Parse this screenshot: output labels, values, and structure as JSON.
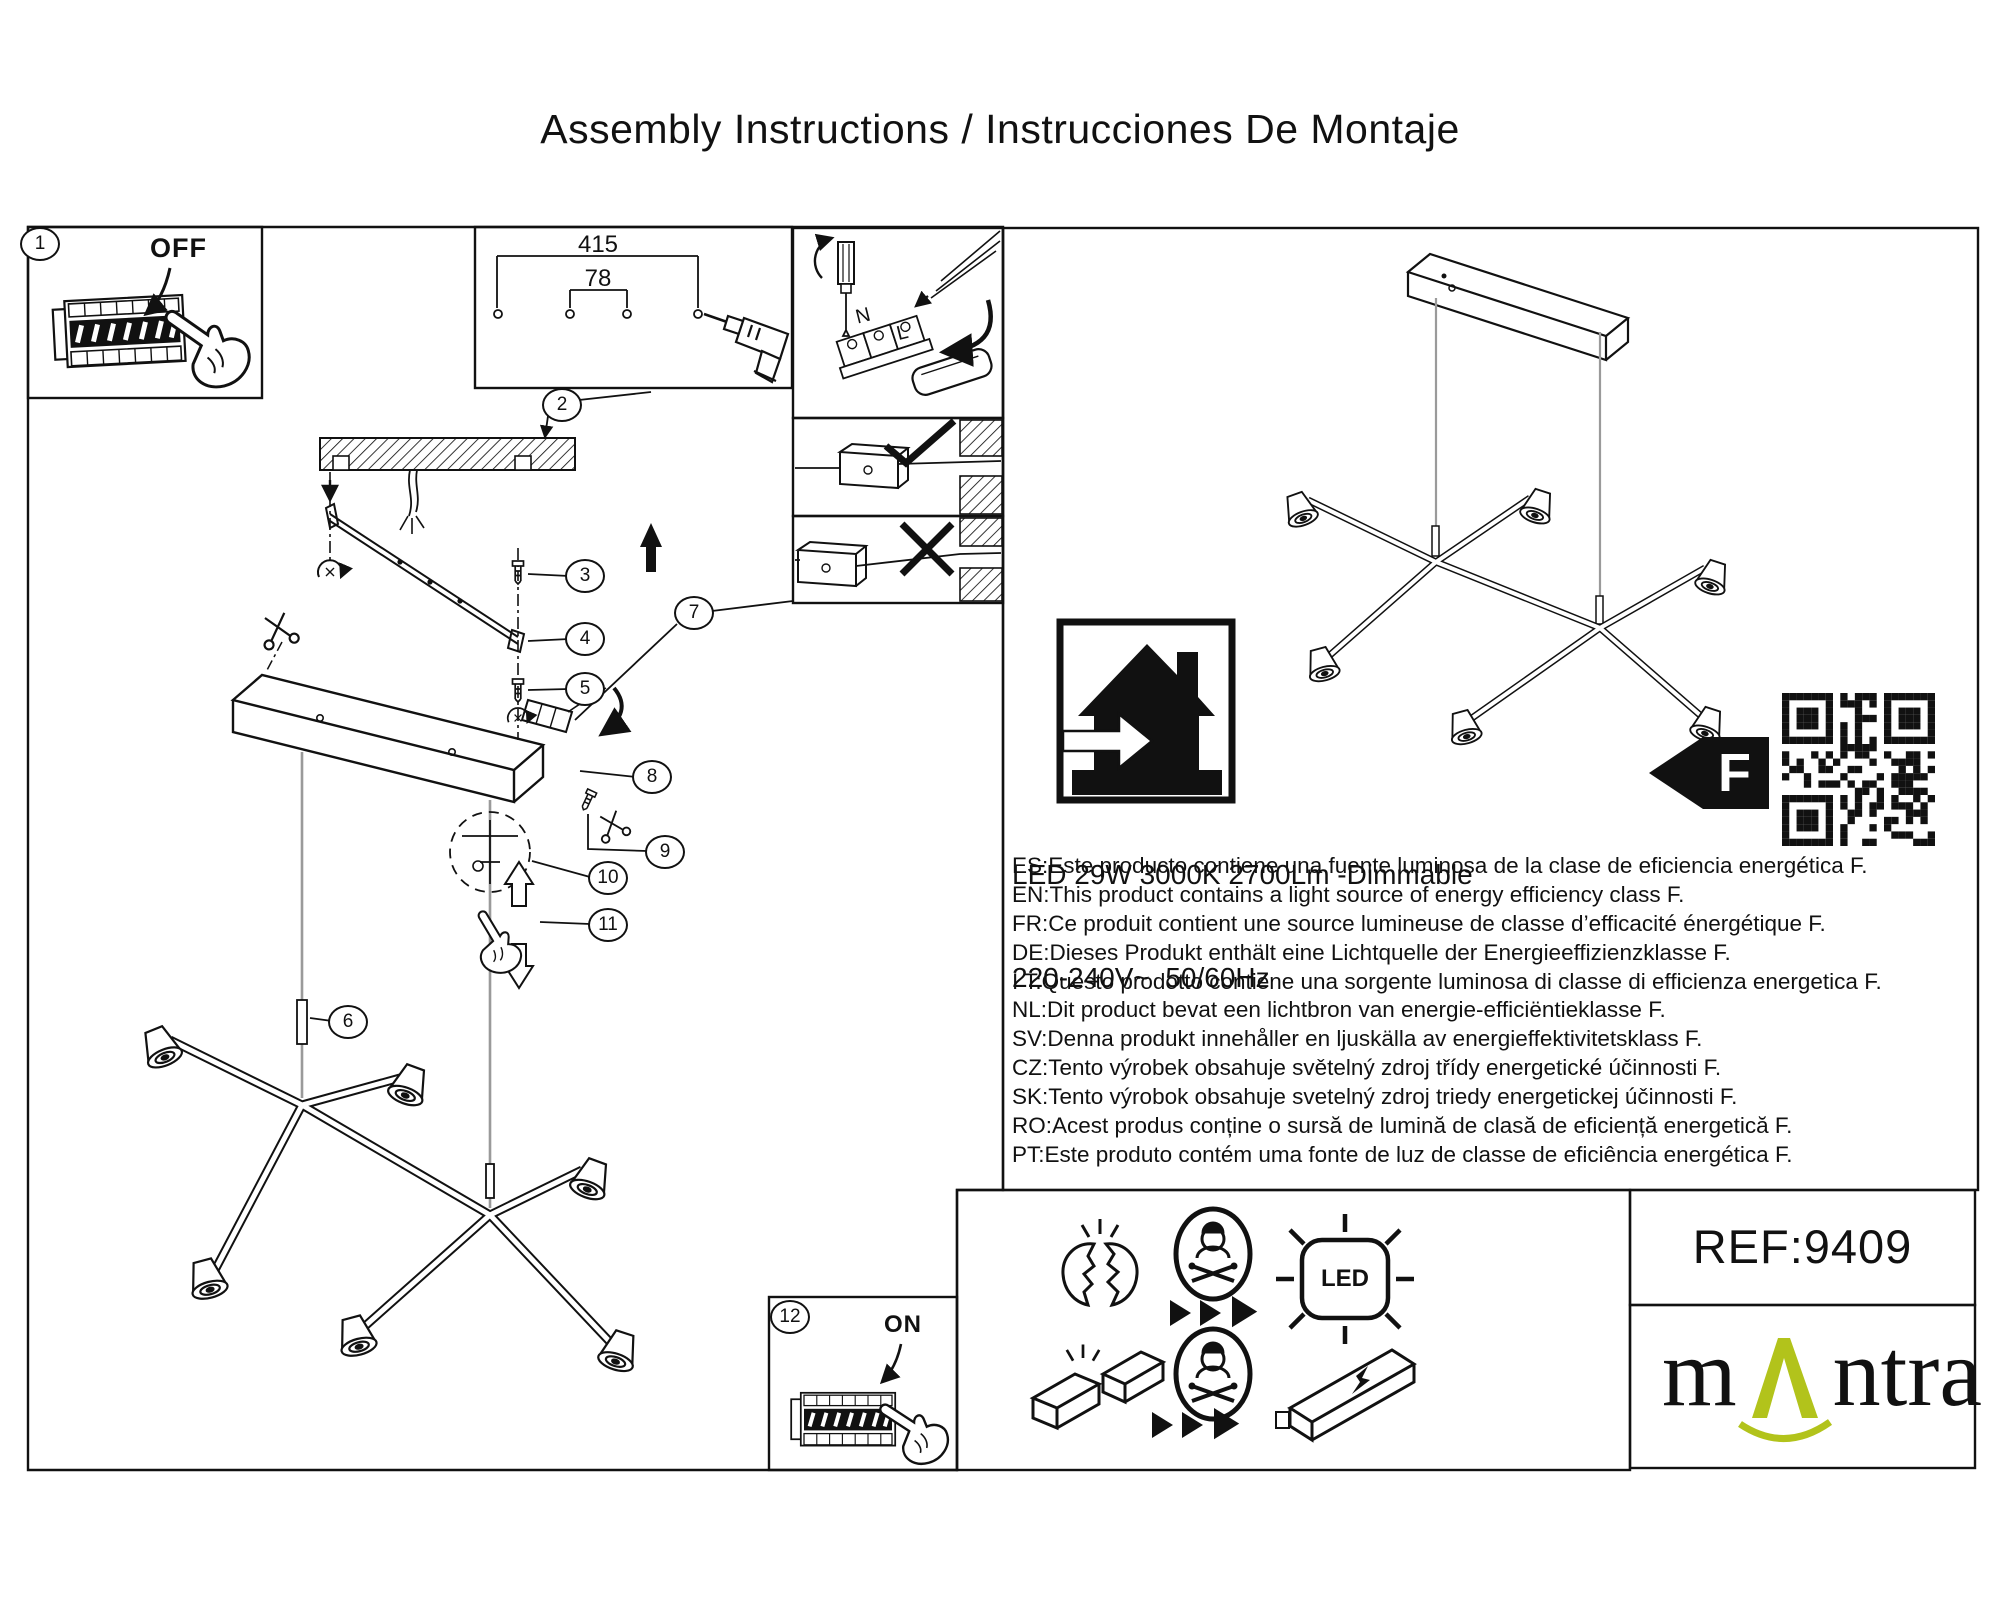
{
  "title": "Assembly Instructions / Instrucciones De Montaje",
  "step_numbers": {
    "s1": "1",
    "s2": "2",
    "s3": "3",
    "s4": "4",
    "s5": "5",
    "s6": "6",
    "s7": "7",
    "s8": "8",
    "s9": "9",
    "s10": "10",
    "s11": "11",
    "s12": "12"
  },
  "breaker": {
    "off_label": "OFF",
    "on_label": "ON"
  },
  "mount_dimensions": {
    "hole_spacing_outer": "415",
    "hole_spacing_inner": "78"
  },
  "terminal": {
    "neutral": "N",
    "live": "L"
  },
  "specs": {
    "line1": "LED 29W 3000K 2700Lm -Dimmable",
    "line2": "220-240V~  50/60Hz"
  },
  "energy_label": {
    "class_letter": "F"
  },
  "languages": [
    "ES:Este producto contiene una fuente luminosa de la clase de eficiencia energética F.",
    "EN:This product contains a light source of energy efficiency class F.",
    "FR:Ce produit contient une source lumineuse de classe d’efficacité énergétique F.",
    "DE:Dieses Produkt enthält eine Lichtquelle der Energieeffizienzklasse F.",
    "I T:Questo prodotto contiene una sorgente luminosa di classe di efficienza energetica F.",
    "NL:Dit product bevat een lichtbron van energie-efficiëntieklasse F.",
    "SV:Denna produkt innehåller en ljuskälla av energieffektivitetsklass F.",
    "CZ:Tento výrobek obsahuje světelný zdroj třídy energetické účinnosti F.",
    "SK:Tento výrobok obsahuje svetelný zdroj triedy energetickej účinnosti F.",
    "RO:Acest produs conține o sursă de lumină de clasă de eficiență energetică F.",
    "PT:Este produto contém uma fonte de luz de classe de eficiência energética F."
  ],
  "icons": {
    "led_text": "LED"
  },
  "footer": {
    "reference": "REF:9409",
    "brand_prefix": "m",
    "brand_suffix": "ntra"
  },
  "colors": {
    "brand_green": "#b2c31b",
    "line": "#111111"
  }
}
